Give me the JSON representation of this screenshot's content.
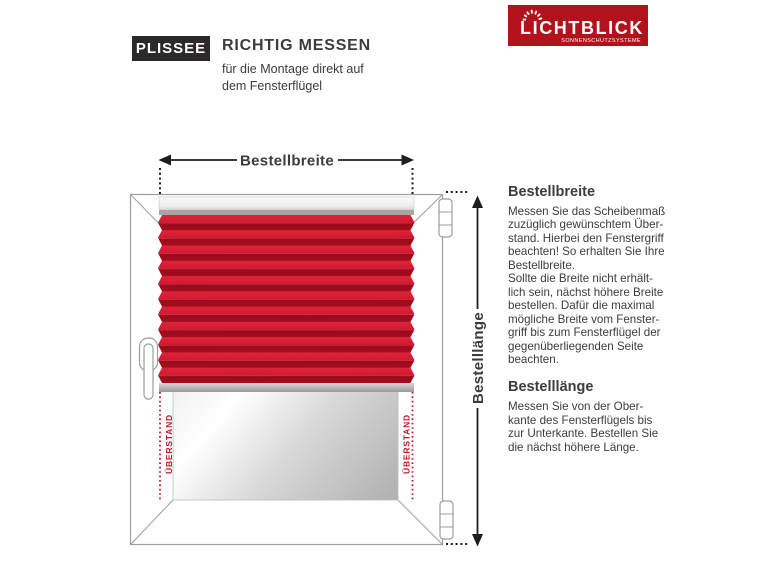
{
  "header": {
    "badge": "PLISSEE",
    "title": "RICHTIG MESSEN",
    "subtitle": "für die Montage direkt auf\ndem Fensterflügel"
  },
  "logo": {
    "brand": "LICHTBLICK",
    "tagline": "SONNENSCHUTZSYSTEME",
    "bg_color": "#b1121b"
  },
  "diagram": {
    "width_label": "Bestellbreite",
    "length_label": "Bestelllänge",
    "overhang_left": "ÜBERSTAND",
    "overhang_right": "ÜBERSTAND",
    "colors": {
      "pleat_bright": "#d21730",
      "pleat_dark": "#a40e1e",
      "overhang_red": "#be1622",
      "frame_gray": "#9d9d9c",
      "arrow_black": "#1d1d1b",
      "rail_gray": "#a6a6a6"
    }
  },
  "instructions": {
    "width": {
      "heading": "Bestellbreite",
      "body": "Messen Sie das Scheibenmaß\nzuzüglich gewünschtem Über-\nstand. Hierbei den Fenstergriff\nbeachten! So erhalten Sie Ihre\nBestellbreite.\nSollte die Breite nicht erhält-\nlich sein, nächst höhere Breite\nbestellen. Dafür die maximal\nmögliche Breite vom Fenster-\ngriff bis zum Fensterflügel der\ngegenüberliegenden Seite\nbeachten."
    },
    "length": {
      "heading": "Bestelllänge",
      "body": "Messen Sie von der Ober-\nkante des Fensterflügels bis\nzur Unterkante. Bestellen Sie\ndie nächst höhere Länge."
    }
  }
}
